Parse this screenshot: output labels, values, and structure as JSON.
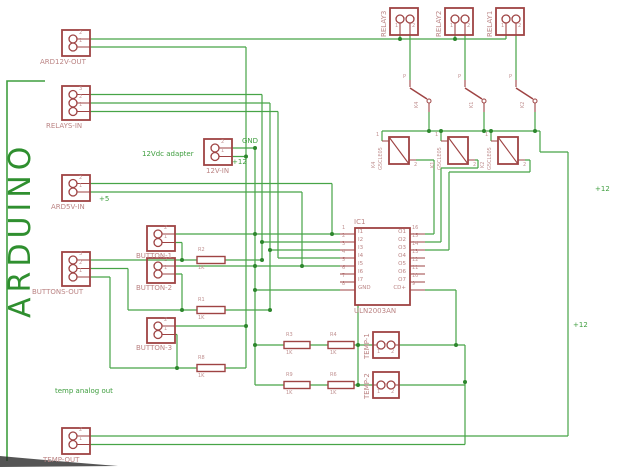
{
  "board_label": "ARDUINO",
  "notes": {
    "adapter": "12Vdc adapter",
    "temp_analog": "temp analog out"
  },
  "net_labels": {
    "gnd": "GND",
    "p12_adapter": "+12",
    "p5": "+5",
    "p12_right_top": "+12",
    "p12_right_bottom": "+12"
  },
  "connectors": {
    "ard12v_out": {
      "label": "ARD12V-OUT",
      "pins": [
        "2",
        "1"
      ]
    },
    "relays_in": {
      "label": "RELAYS-IN",
      "pins": [
        "3",
        "2",
        "1"
      ]
    },
    "v12_in": {
      "label": "12V-IN",
      "pins": [
        "2",
        "1"
      ]
    },
    "ard5v_in": {
      "label": "ARD5V-IN",
      "pins": [
        "2",
        "1"
      ]
    },
    "buttons_out": {
      "label": "BUTTONS-OUT",
      "pins": [
        "3",
        "2",
        "1"
      ]
    },
    "button1": {
      "label": "BUTTON-1",
      "pins": [
        "2",
        "1"
      ]
    },
    "button2": {
      "label": "BUTTON-2",
      "pins": [
        "2",
        "1"
      ]
    },
    "button3": {
      "label": "BUTTON-3",
      "pins": [
        "2",
        "1"
      ]
    },
    "temp_out": {
      "label": "TEMP-OUT",
      "pins": [
        "2",
        "1"
      ]
    },
    "temp1": {
      "label": "TEMP-1",
      "pins": [
        "1",
        "2"
      ]
    },
    "temp2": {
      "label": "TEMP-2",
      "pins": [
        "1",
        "2"
      ]
    },
    "relay3": {
      "label": "RELAY3",
      "pins": [
        "1",
        "2"
      ]
    },
    "relay2": {
      "label": "RELAY2",
      "pins": [
        "1",
        "2"
      ]
    },
    "relay1": {
      "label": "RELAY1",
      "pins": [
        "1",
        "2"
      ]
    }
  },
  "ic": {
    "name": "IC1",
    "part": "ULN2003AN",
    "left_pins": [
      {
        "num": "1",
        "label": "I1"
      },
      {
        "num": "2",
        "label": "I2"
      },
      {
        "num": "3",
        "label": "I3"
      },
      {
        "num": "4",
        "label": "I4"
      },
      {
        "num": "5",
        "label": "I5"
      },
      {
        "num": "6",
        "label": "I6"
      },
      {
        "num": "7",
        "label": "I7"
      },
      {
        "num": "8",
        "label": "GND"
      }
    ],
    "right_pins": [
      {
        "num": "16",
        "label": "O1"
      },
      {
        "num": "15",
        "label": "O2"
      },
      {
        "num": "14",
        "label": "O3"
      },
      {
        "num": "13",
        "label": "O4"
      },
      {
        "num": "12",
        "label": "O5"
      },
      {
        "num": "11",
        "label": "O6"
      },
      {
        "num": "10",
        "label": "O7"
      },
      {
        "num": "9",
        "label": "CD+"
      }
    ]
  },
  "resistors": {
    "r2": {
      "name": "R2",
      "value": "1K"
    },
    "r1": {
      "name": "R1",
      "value": "1K"
    },
    "r8": {
      "name": "R8",
      "value": "1K"
    },
    "r3": {
      "name": "R3",
      "value": "1K"
    },
    "r4": {
      "name": "R4",
      "value": "1K"
    },
    "r9": {
      "name": "R9",
      "value": "1K"
    },
    "r6": {
      "name": "R6",
      "value": "1K"
    }
  },
  "relays": [
    {
      "name": "K4",
      "value": "G5CLE05",
      "pole": "P",
      "coil_pins": [
        "1",
        "2"
      ]
    },
    {
      "name": "K1",
      "value": "G5CLE05",
      "pole": "P",
      "coil_pins": [
        "1",
        "2"
      ]
    },
    {
      "name": "K2",
      "value": "G5CLE05",
      "pole": "P",
      "coil_pins": [
        "1",
        "2"
      ]
    }
  ],
  "colors": {
    "wire": "#47a447",
    "junction": "#2d862d",
    "component": "#9e4343",
    "component_text": "#bb8484",
    "annotation": "#3f9e3f",
    "board_label": "#2f8f2f"
  }
}
